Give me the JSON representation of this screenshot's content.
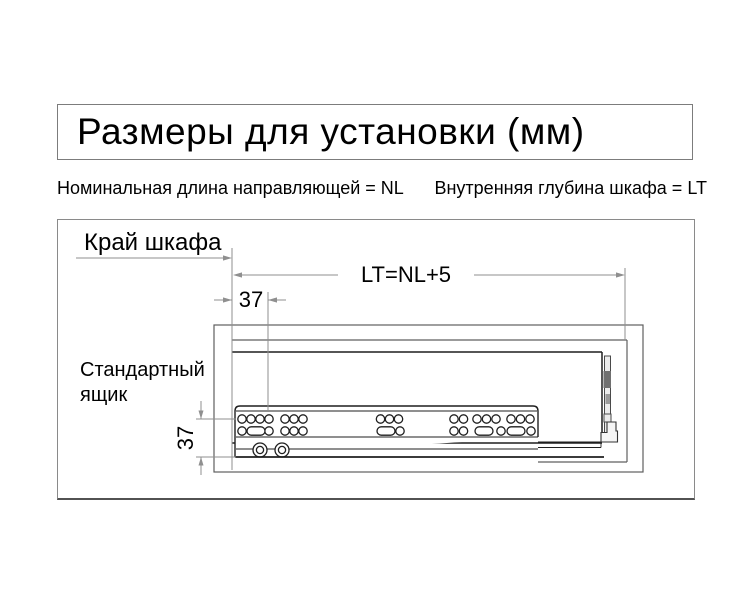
{
  "title": {
    "text": "Размеры для установки (мм)"
  },
  "legend": {
    "left": "Номинальная длина направляющей = NL",
    "right": "Внутренняя глубина шкафа = LT"
  },
  "diagram": {
    "labels": {
      "cabinet_edge": "Край шкафа",
      "standard_drawer_line1": "Стандартный",
      "standard_drawer_line2": "ящик"
    },
    "dimensions": {
      "depth": "LT=NL+5",
      "front_hole_offset": "37",
      "bottom_hole_offset": "37"
    }
  },
  "colors": {
    "dim-line": "#8f8f8f",
    "cabinet-line": "#5f5f5f",
    "dark-line": "#1f1f1f",
    "text": "#000000",
    "background": "#ffffff"
  }
}
